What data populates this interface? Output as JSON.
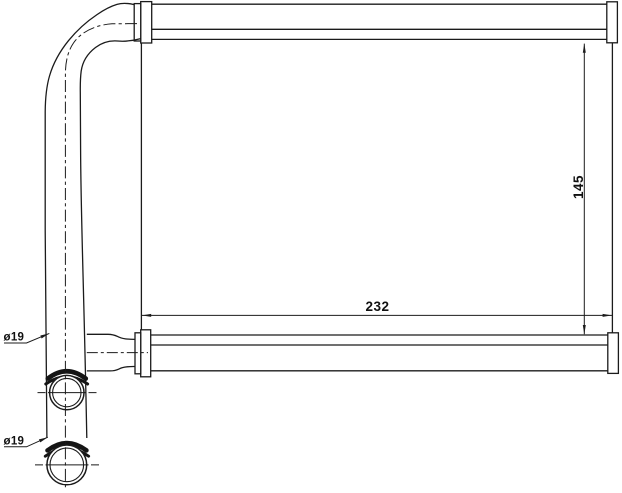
{
  "drawing": {
    "background": "#ffffff",
    "line_color": "#1b1b1b",
    "labels": {
      "core_width": "232",
      "core_height": "145",
      "top_pipe_diameter": "ø19",
      "bottom_pipe_diameter": "ø19"
    }
  }
}
